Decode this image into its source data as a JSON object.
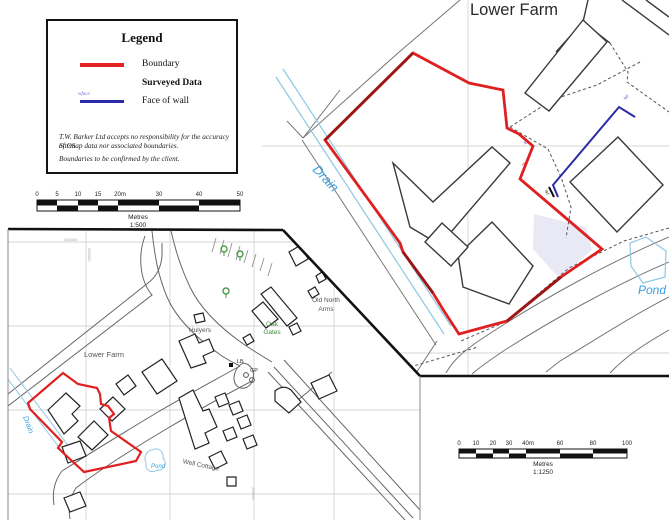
{
  "legend": {
    "title": "Legend",
    "boundary_label": "Boundary",
    "surveyed_data_label": "Surveyed Data",
    "face_of_wall_label": "Face of wall",
    "wall_tag": "wface",
    "disclaimer_line1": "T.W. Barker Ltd accepts no responsibility for the accuracy of OS",
    "disclaimer_line2": "Sitemap data nor associated boundaries.",
    "disclaimer_line3": "Boundaries to be confirmed by the client."
  },
  "scalebar_500": {
    "ticks": [
      "0",
      "5",
      "10",
      "15",
      "20m",
      "30",
      "40",
      "50"
    ],
    "unit_label": "Metres",
    "ratio_label": "1:500"
  },
  "scalebar_1250": {
    "ticks": [
      "0",
      "10",
      "20",
      "30",
      "40m",
      "60",
      "80",
      "100"
    ],
    "unit_label": "Metres",
    "ratio_label": "1:1250"
  },
  "large_map": {
    "title": "Lower Farm",
    "drain_label": "Drain",
    "pond_label": "Pond",
    "wall_tag_top": "wf",
    "wall_tag_bottom": "wf",
    "tag_t": "T",
    "tag_w": "w"
  },
  "overview_map": {
    "lower_farm_label": "Lower Farm",
    "hulyers_label": "Hulyers",
    "oak_label": "Oak",
    "gates_label": "Gates",
    "old_north_label": "Old North",
    "arms_label": "Arms",
    "well_cottage_label": "Well Cottage",
    "pond_label": "Pond",
    "drain_label": "Drain",
    "lb_label": "LB",
    "gp_label": "GP",
    "grid_label_e": "258400",
    "grid_label_s": "258300"
  },
  "colors": {
    "boundary_red": "#e02020",
    "boundary_red_dark": "#9b1616",
    "wall_blue": "#2a2aa8",
    "water_light": "#8ec7e4",
    "water_text": "#3aa0e0",
    "building_gray": "#3a3a3a",
    "road_gray": "#777777",
    "grid_gray": "#d6d6d6",
    "tree_green": "#4a9a4a",
    "green_text": "#3e8a3e",
    "lavender_fill": "#e9e9f6"
  }
}
